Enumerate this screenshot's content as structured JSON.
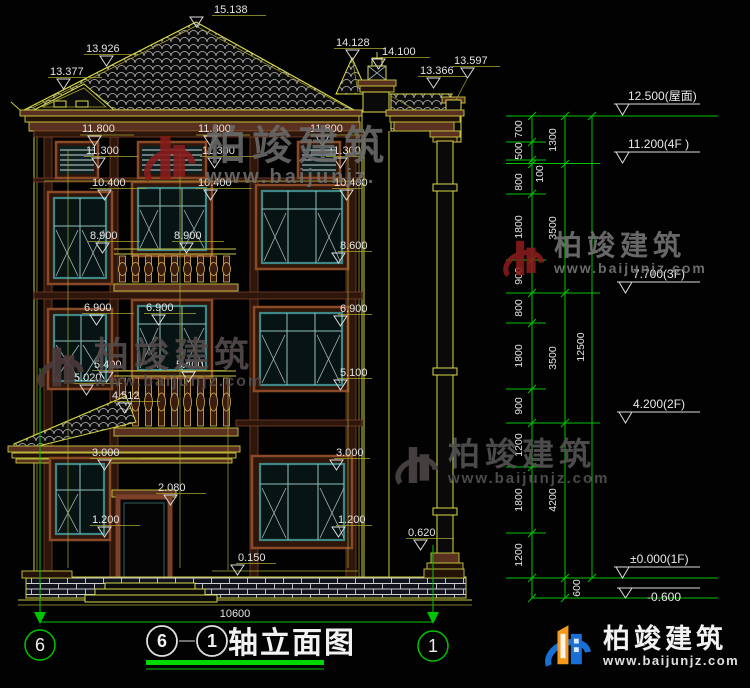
{
  "drawing": {
    "title_text": "轴立面图",
    "bubble_left": "6",
    "bubble_right": "1",
    "overall_width": "10600"
  },
  "axes": {
    "left": "6",
    "right": "1"
  },
  "dims": {
    "roof": [
      "15.138",
      "13.926",
      "13.377",
      "14.128",
      "14.100",
      "13.366",
      "13.597"
    ],
    "r118": [
      "11.800",
      "11.800",
      "11.800"
    ],
    "r113": [
      "11.300",
      "11.300",
      "11.300"
    ],
    "r104": [
      "10.400",
      "10.400",
      "10.400"
    ],
    "r89": [
      "8.900",
      "8.900",
      "8.600"
    ],
    "r69": [
      "6.900",
      "6.900",
      "6.900"
    ],
    "r54": [
      "5.400",
      "5.400",
      "5.100"
    ],
    "misc": [
      "5.020",
      "4.512",
      "3.000",
      "3.000",
      "2.080",
      "1.200",
      "1.200",
      "0.150",
      "0.620"
    ]
  },
  "chain": {
    "col1": [
      "700",
      "500",
      "100",
      "800",
      "1800",
      "900",
      "800",
      "1800",
      "900",
      "1200",
      "1800",
      "1200"
    ],
    "col2": [
      "1300",
      "3500",
      "3500",
      "4200",
      "600"
    ],
    "col3": [
      "12500"
    ]
  },
  "elevations": [
    "12.500(屋面)",
    "11.200(4F )",
    "7.700(3F)",
    "4.200(2F)",
    "±0.000(1F)",
    "-0.600"
  ],
  "watermark": {
    "name": "柏竣建筑",
    "url": "www.baijunjz.com",
    "url_short": "www.baijunjz."
  },
  "logo": {
    "name": "柏竣建筑",
    "url": "www.baijunjz.com"
  },
  "colors": {
    "background": "#020202",
    "line_yellow": "#c9c93f",
    "dim_green": "#00c400",
    "text_white": "#e4e4e4",
    "window_teal": "#3f8787",
    "trim_brown": "#5a3020",
    "watermark_red": "#8a1c1c",
    "logo_blue": "#1a6fd4",
    "logo_orange": "#f59a1a",
    "title_green": "#00d800"
  }
}
